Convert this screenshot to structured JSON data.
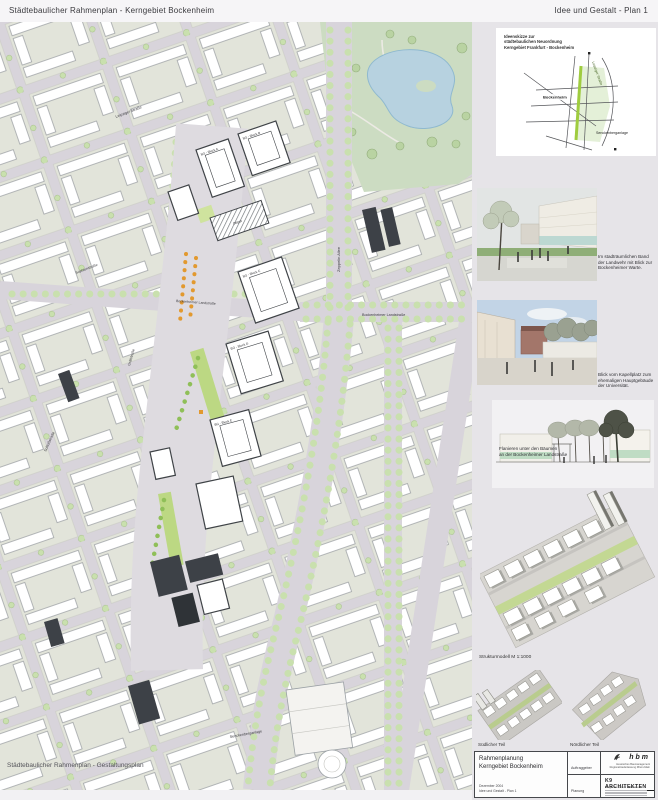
{
  "header": {
    "left_title": "Städtebaulicher Rahmenplan - Kerngebiet Bockenheim",
    "right_title": "Idee und Gestalt - Plan 1"
  },
  "map": {
    "overlay_caption": "Städtebaulicher Rahmenplan - Gestaltungsplan",
    "streets": {
      "zeppelinallee": "Zeppelin Allee",
      "bockenheimer": "Bockenheimer Landstraße",
      "bockenheimer_w": "Bockenheimer Landstraße",
      "senckenberganlage": "Senckenberganlage",
      "leipziger": "Leipziger Straße",
      "graefstrasse": "Gräfstraße",
      "schlossstrasse": "Schloßstraße",
      "sophienstrasse": "Sophienstraße"
    },
    "blocks": {
      "a": "BG - Block A",
      "b": "BG - Block B",
      "c": "BG - Block C",
      "d": "BG - Block D",
      "e": "BG - Block E",
      "depot": "Depot"
    }
  },
  "sidebar": {
    "locator": {
      "caption_line1": "Ideenskizze zur",
      "caption_line2": "städtebaulichen Neuordnung",
      "caption_line3": "Kerngebiet Frankfurt - Bockenheim",
      "label_bockenheim": "Bockenheim",
      "label_senckenberganlage": "Senckenberganlage",
      "label_leipziger": "Leipziger Straße"
    },
    "view1_caption": "Im stadträumlichen Band der Landwehr mit Blick zur Bockenheimer Warte.",
    "view2_caption": "Blick vom Kapellplatz zum ehemaligen Hauptgebäude der Universität.",
    "view3_caption_line1": "Flanieren unter den Bäumen",
    "view3_caption_line2": "an der Bockenheimer Landstraße",
    "model_caption": "Strukturmodell  M 1:1000",
    "model_south": "Südlicher Teil",
    "model_north": "Nördlicher Teil"
  },
  "titleblock": {
    "project_line1": "Rahmenplanung",
    "project_line2": "Kerngebiet Bockenheim",
    "date": "Dezember 2004",
    "plan_name": "Idee und Gestalt - Plan 1",
    "client_label": "Auftraggeber",
    "client_logo": "hbm",
    "client_sub1": "Hessisches Baumanagement",
    "client_sub2": "Regionalniederlassung Rhein-Main",
    "planner_label": "Planung",
    "planner_logo": "K9 ARCHITEKTEN",
    "planner_sub": "Borgards . Lösch . Piribauer"
  },
  "colors": {
    "street": "#d8d4db",
    "block": "#e2e4da",
    "park": "#ccdcc2",
    "pond": "#b7d2e0",
    "tree": "#c9e0ae",
    "axis_green": "#bcd883",
    "accent_orange": "#e2992f",
    "dark_building": "#3d4147",
    "sidebar_bg": "#e6e4e8"
  }
}
